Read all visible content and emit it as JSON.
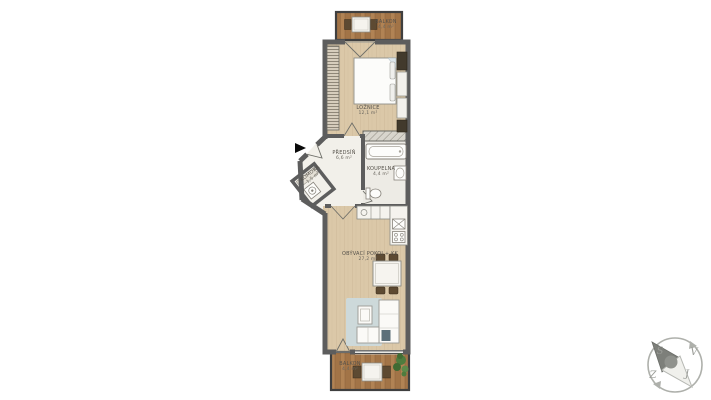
{
  "plan": {
    "type": "apartment-floor-plan",
    "rooms": {
      "balcony_top": {
        "name": "BALKON",
        "area": "4,4 m²"
      },
      "bedroom": {
        "name": "LOŽNICE",
        "area": "12,1 m²"
      },
      "hall": {
        "name": "PŘEDSÍŇ",
        "area": "6,6 m²"
      },
      "bathroom": {
        "name": "KOUPELNA",
        "area": "4,4 m²"
      },
      "storage": {
        "name": "KOMORA",
        "area": "1,5 m²"
      },
      "living": {
        "name": "OBÝVACÍ POKOJ + KK",
        "area": "27,2 m²"
      },
      "balcony_bottom": {
        "name": "BALKON",
        "area": "4,4 m²"
      }
    }
  },
  "compass": {
    "north": "S",
    "east": "V",
    "south": "J",
    "west": "Z"
  },
  "colors": {
    "background": "#ffffff",
    "wall": "#5d5d5d",
    "wood_floor": "#dbc8a8",
    "deck": "#b18354",
    "hall_floor": "#f2f0ea",
    "bath_floor": "#edebe5",
    "rug": "#cdd9da",
    "dark_furniture": "#5d4a32",
    "plant": "#4e7c3e",
    "entrance_arrow": "#0a0a0a",
    "compass_gray": "#9a9c97"
  }
}
